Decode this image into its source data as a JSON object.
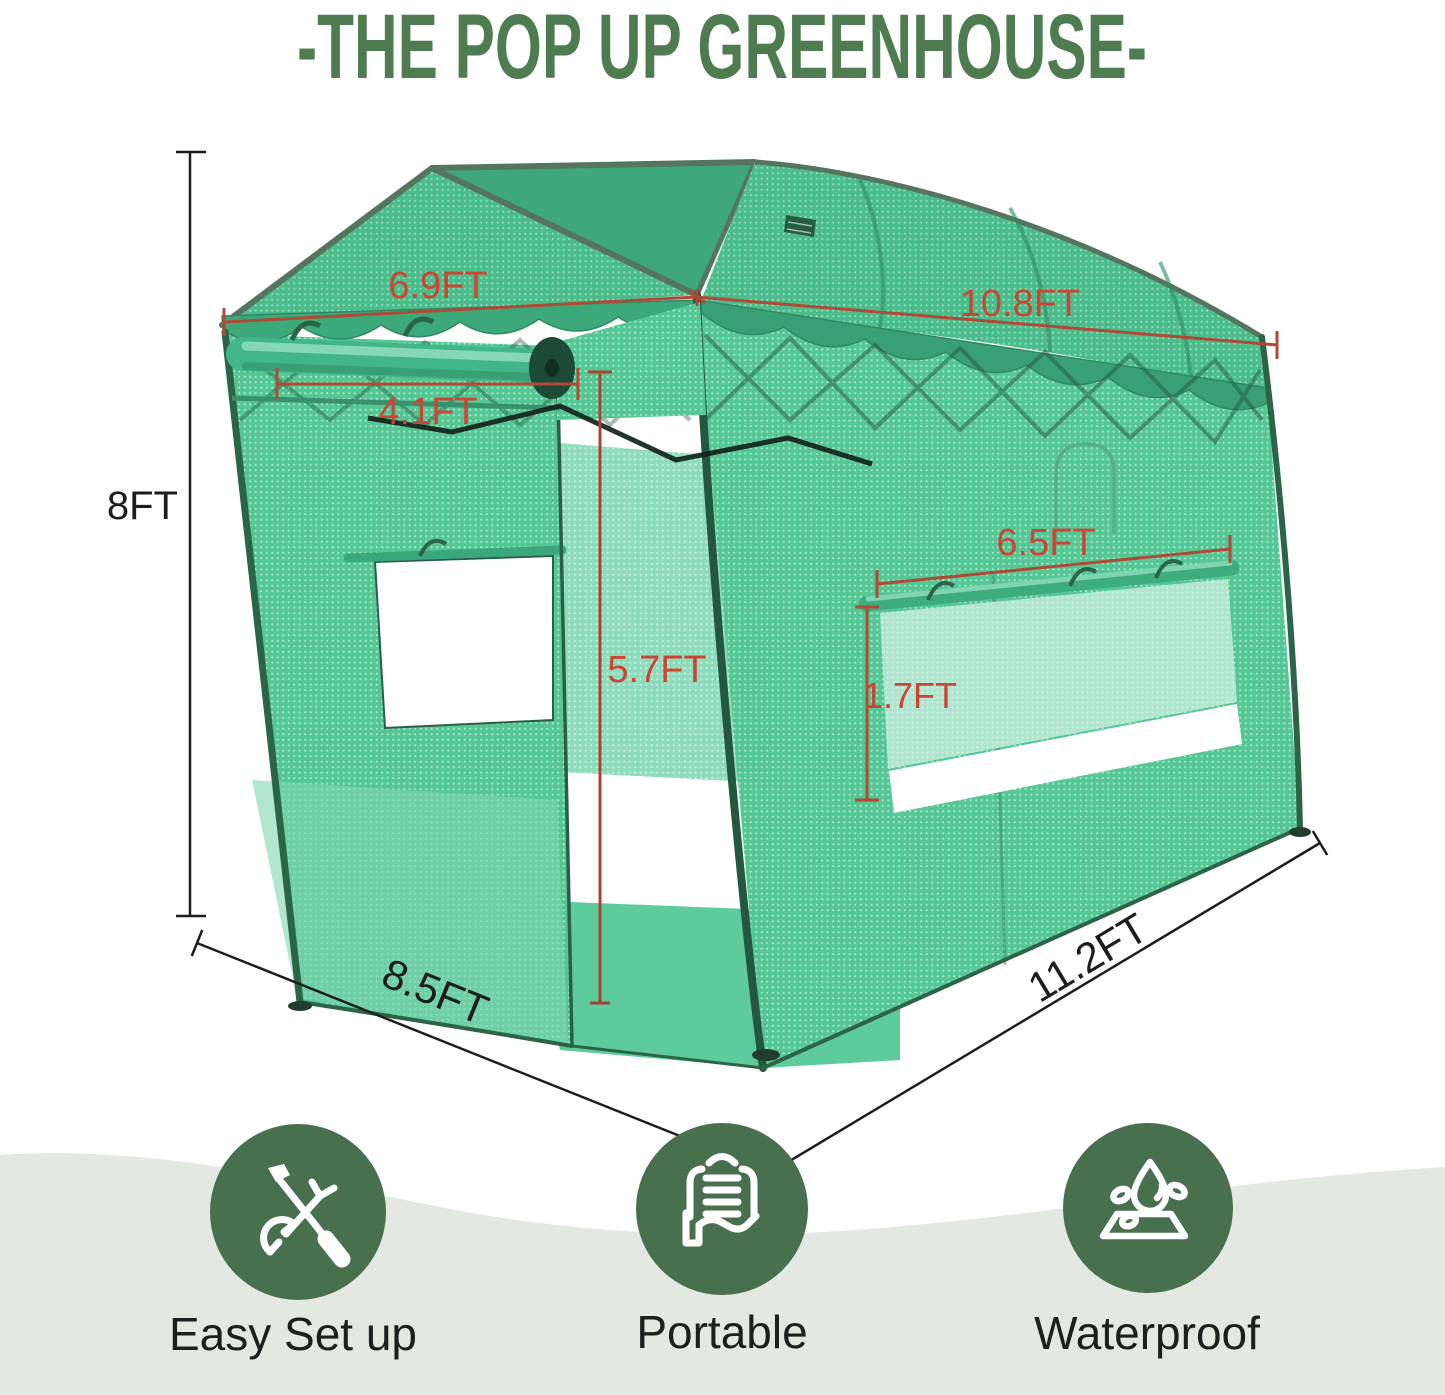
{
  "title": "-THE POP UP GREENHOUSE-",
  "dimensions": {
    "height": "8FT",
    "canopy_width": "6.9FT",
    "roof_length": "10.8FT",
    "door_width": "4.1FT",
    "door_height": "5.7FT",
    "window_width": "6.5FT",
    "window_height": "1.7FT",
    "base_depth": "8.5FT",
    "base_length": "11.2FT"
  },
  "features": [
    {
      "label": "Easy Set up",
      "icon": "tools-icon"
    },
    {
      "label": "Portable",
      "icon": "carry-bag-hand-icon"
    },
    {
      "label": "Waterproof",
      "icon": "water-drop-icon"
    }
  ],
  "colors": {
    "title_green": "#4e7c50",
    "mesh_green": "#55c795",
    "mesh_roof_green": "#4bbd8b",
    "mesh_light_green": "#8edcbb",
    "frame_green": "#2c6448",
    "valance_green": "#3da87a",
    "dimension_red": "#c8402f",
    "dimension_black": "#1d1d1d",
    "feature_circle_green": "#49704e",
    "wave_background": "#e3e8e1"
  }
}
